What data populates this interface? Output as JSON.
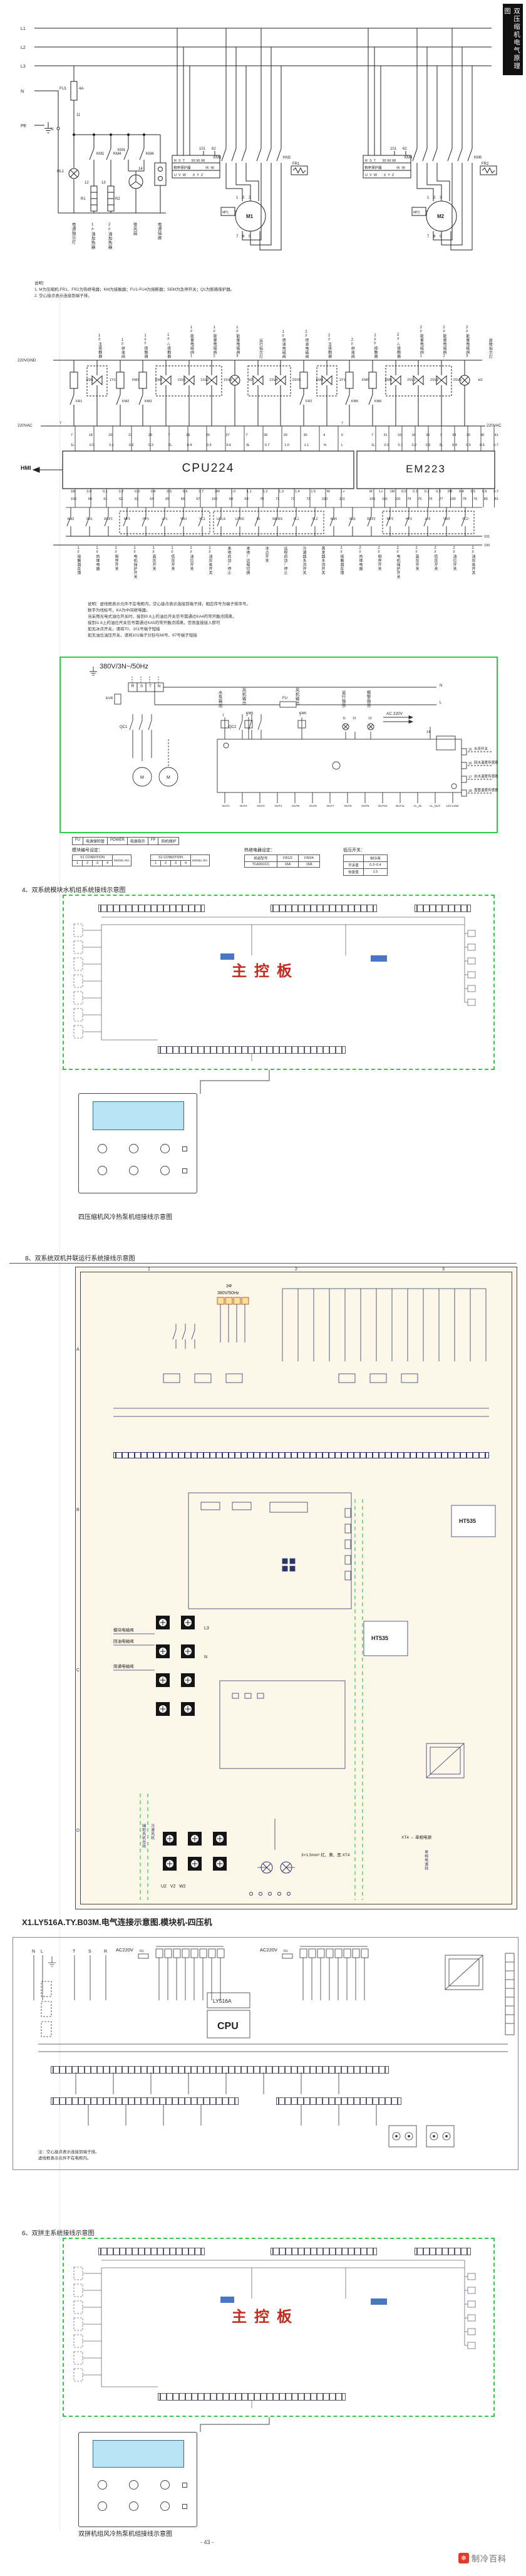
{
  "page": {
    "side_tab": "双压缩机电气原理图",
    "page_number": "- 43 -",
    "brand": "制冷百科",
    "brand_icon_glyph": "❄"
  },
  "s1": {
    "l1": "L1",
    "l2": "L2",
    "l3": "L3",
    "n": "N",
    "pe": "PE",
    "n_node": "N",
    "fu1": "FU1",
    "fu1_rating": "4A",
    "w11": "11",
    "w12": "12",
    "w13": "13",
    "w14": "14",
    "hl1": "HL1",
    "r1": "R1",
    "r2": "R2",
    "ctl_contacts": [
      "KM1",
      "KM4",
      "KM1",
      "KM4"
    ],
    "captions": [
      "电源指示灯",
      "1#油加热器",
      "2#油加热器",
      "排风扇",
      "电源插座"
    ],
    "pp_title": "相序保护器",
    "pp_top": "R  S  T       93 96 98",
    "pp_bot": "U  V  W       X  Y  Z",
    "pp_aux": "95  98",
    "pp_w101": "101",
    "pp_w62": "62",
    "km_m1a": "KM1",
    "km_m1b": "KM2",
    "km_m2a": "KM4",
    "km_m2b": "KM5",
    "fr1": "FR1",
    "fr2": "FR2",
    "m1": "M1",
    "m2": "M2",
    "mp1": "MP1",
    "mp2": "MP2",
    "wind_top": "1    2    3",
    "wind_bot": "7    8    9",
    "notes": [
      "说明：",
      "1. M为压缩机;FR1、FR2为热继电器；KM为接触器；FU1-FU4为熔断器；SEM为急停开关；Q1为断路保护器。",
      "2. 空心接点表示连接到端子排。"
    ]
  },
  "s2": {
    "rail_gnd": "220VGND",
    "rail_ac_left": "220VAC",
    "rail_ac_right": "220VAC",
    "w7a": "7",
    "w7b": "7",
    "out_tags": [
      "KM1",
      "1Y1",
      "KM3",
      "KM2",
      "1SV1",
      "1SV2",
      "1SV3",
      "H2",
      "1SV4",
      "2SV5",
      "KM4",
      "2Y1",
      "KM6",
      "KM5",
      "2SV1",
      "2SV2",
      "2SV3",
      "H3"
    ],
    "out_caps": [
      "1#主接触器",
      "1#供液阀",
      "1#Y接触器",
      "1#△接触器",
      "1#能量电磁阀1",
      "1#能量电磁阀2",
      "1#能量电磁阀3",
      "运行指示灯",
      "1#喷液电磁阀",
      "2#喷液电磁阀",
      "2#主接触器",
      "2#供液阀",
      "2#Y接触器",
      "2#△接触器",
      "2#能量电磁阀1",
      "2#能量电磁阀2",
      "2#能量电磁阀3",
      "故障指示灯"
    ],
    "aux_tags": [
      "FR1",
      "KM2",
      "KM3",
      "FR2",
      "KM5",
      "KM6"
    ],
    "hmi": "HMI",
    "cpu": "CPU224",
    "em": "EM223",
    "cpu_top_wires": [
      "7",
      "18",
      "20",
      "21",
      "23",
      "7",
      "25",
      "26",
      "27",
      "7",
      "28",
      "29",
      "30",
      "4",
      "6"
    ],
    "cpu_top_terms": [
      "1L",
      "0.0",
      "0.1",
      "0.2",
      "0.3",
      "2L",
      "0.4",
      "0.5",
      "0.6",
      "3L",
      "0.7",
      "1.0",
      "1.1",
      "N",
      "L"
    ],
    "em_top_wires": [
      "7",
      "31",
      "33",
      "34",
      "36",
      "7",
      "38",
      "39",
      "40",
      "41"
    ],
    "em_top_terms": [
      "1L",
      "0.0",
      "0.1",
      "0.2",
      "0.3",
      "2L",
      "0.4",
      "0.5",
      "0.6",
      "0.7"
    ],
    "cpu_bot_terms": [
      "1M",
      "0.0",
      "0.1",
      "0.2",
      "0.3",
      "0.4",
      "0.5",
      "0.6",
      "0.7",
      "2M",
      "1.0",
      "1.1",
      "1.2",
      "1.3",
      "1.4",
      "1.5",
      "M",
      "L+"
    ],
    "cpu_bot_wires": [
      "100",
      "60",
      "61",
      "62",
      "63",
      "64",
      "65",
      "66",
      "67",
      "100",
      "68",
      "69",
      "70",
      "71",
      "72",
      "73",
      "100",
      "101"
    ],
    "em_bot_terms": [
      "M",
      "L+",
      "1M",
      "0.0",
      "0.1",
      "0.2",
      "0.3",
      "2M",
      "0.4",
      "0.5",
      "0.6",
      "0.7"
    ],
    "em_bot_wires": [
      "100",
      "101",
      "100",
      "74",
      "75",
      "76",
      "77",
      "100",
      "78",
      "79",
      "80",
      "81"
    ],
    "in_tags": [
      "KM2",
      "FR1",
      "RCP1",
      "MP1",
      "HP1",
      "LP1",
      "YW1",
      "YC1",
      "LR/LS",
      "LC/RC",
      "B1",
      "RR/RS",
      "SL1",
      "SL2",
      "KM5",
      "FR2",
      "RCP2",
      "MP2",
      "HP2",
      "LP2",
      "YW2",
      "YC2"
    ],
    "in_caps": [
      "1#接触器反馈",
      "1#热继电器",
      "1#相序开关",
      "1#电机保护开关",
      "1#高压开关",
      "1#低压开关",
      "1#油位开关",
      "1#油压差开关",
      "本地启动/停止",
      "本地/远程切换",
      "冰点开关",
      "远程启动/停止",
      "冷凝器水流开关",
      "蒸发器水流开关",
      "2#接触器反馈",
      "2#热继电器",
      "2#相序开关",
      "2#电机保护开关",
      "2#高压开关",
      "2#低压开关",
      "2#油位开关",
      "2#油压差开关"
    ],
    "w101": "101",
    "w100": "100",
    "notes": [
      "说明：虚线框表示元件不在电柜内，空心接点表示连接到端子排，相应序号为端子排序号。",
      "数字为线标号，KA为中间继电器。",
      "当采用光电式油位开关时，接到I0.6上的油位开关信号需通过KA4的常开触点隔离，",
      "接到I1.6上的油位开关信号需通过KA5的常开触点隔离，否则直接接入即可",
      "如无冰点开关，请将70、101号端子短接",
      "如无油位油压开关，请将101端子分别与66号、67号端子短接"
    ]
  },
  "s3": {
    "power": "380V/3N~/50Hz",
    "terms": [
      "R",
      "S",
      "T",
      "N"
    ],
    "evr": "EVR",
    "fu": "FU",
    "l": "L",
    "n": "N",
    "qc1": "QC1",
    "qc2": "QC2",
    "m": "M",
    "callout_pump": "水泵输出",
    "callout_fan1": "风机输出",
    "callout_fan2": "风机输出",
    "callout_run": "运行指示",
    "callout_alarm": "报警指示",
    "km5": "KM5",
    "km6": "KM6",
    "ac": "AC 220V",
    "w14": "14",
    "wire_nums": [
      "1",
      "2",
      "7",
      "11",
      "12",
      "13"
    ],
    "board_terms": [
      "OUT1",
      "OUT2",
      "OUT3",
      "OUT4",
      "OUT5",
      "OUT6",
      "OUT7",
      "OUT8",
      "OUT9",
      "OUT10",
      "OUT11",
      "AL_IN",
      "AL_OUT",
      "12V-COM"
    ],
    "sensor_nums": [
      "15",
      "16",
      "17",
      "18"
    ],
    "sensor_caps": [
      "水流开关",
      "回水温度传感器",
      "出水温度传感器",
      "盘管温度传感器"
    ],
    "legend": [
      "FU",
      "电源保险管",
      "POWER",
      "电源指示",
      "FP",
      "风机保护"
    ],
    "t1_title": "模块编号设定：",
    "t1_h": "S1 CONDITION",
    "t1_h2": "MODEL NO.",
    "t1_c1": "1",
    "t1_c2": "2",
    "t1_c3": "3",
    "t1_c4": "4",
    "t2_title": "热继电器设定：",
    "t2_r1": [
      "机组型号",
      "FR1/2",
      "FR3/4"
    ],
    "t2_r2": [
      "TCA301CC",
      "16A",
      "16A"
    ],
    "t3_title": "低压开关：",
    "t3_r1": [
      "",
      "制冷用"
    ],
    "t3_r2": [
      "开关值",
      "0.3~0.4"
    ],
    "t3_r3": [
      "恢复值",
      "1.5"
    ]
  },
  "s4": {
    "heading": "4、双系统模块水机组系统接线示意图",
    "board": "主控板",
    "caption": "四压缩机风冷热泵机组接线示意图"
  },
  "s5": {
    "heading": "8、双系统双机并联运行系统接线示意图",
    "power_line1": "3Φ",
    "power_line2": "380V/50Hz",
    "chip": "HT535",
    "chip2": "HT535",
    "valve_labels": [
      "模块电磁阀",
      "回油电磁阀",
      "旁通电磁阀"
    ],
    "fan_label1": "辅助风机出线",
    "fan_label2": "冷凝风机",
    "u2v2w2": "U2   V2   W2",
    "l3": "L3",
    "n": "N",
    "wire_spec": "3×1.5mm²  红、黄、黑  XT4",
    "xt4": "XT4 → 单相电源",
    "single_phase": "单相电源线",
    "grid_nums": [
      "1",
      "2",
      "3"
    ],
    "grid_letters": [
      "A",
      "B",
      "C",
      "D"
    ]
  },
  "s6": {
    "heading": "X1.LY516A.TY.B03M.电气连接示意图.模块机-四压机",
    "nl": [
      "N",
      "L"
    ],
    "tsr": [
      "T",
      "S",
      "R"
    ],
    "ac1": "AC220V",
    "ac2": "AC220V",
    "fu": "FU",
    "module": "LY516A",
    "cpu": "CPU",
    "notes": [
      "注：空心接点表示连接到端子排。",
      "虚线框表示元件不在电柜内。"
    ]
  },
  "s7": {
    "heading": "6、双拼主系统接线示意图",
    "board": "主控板",
    "caption": "双拼机组风冷热泵机组接线示意图"
  }
}
